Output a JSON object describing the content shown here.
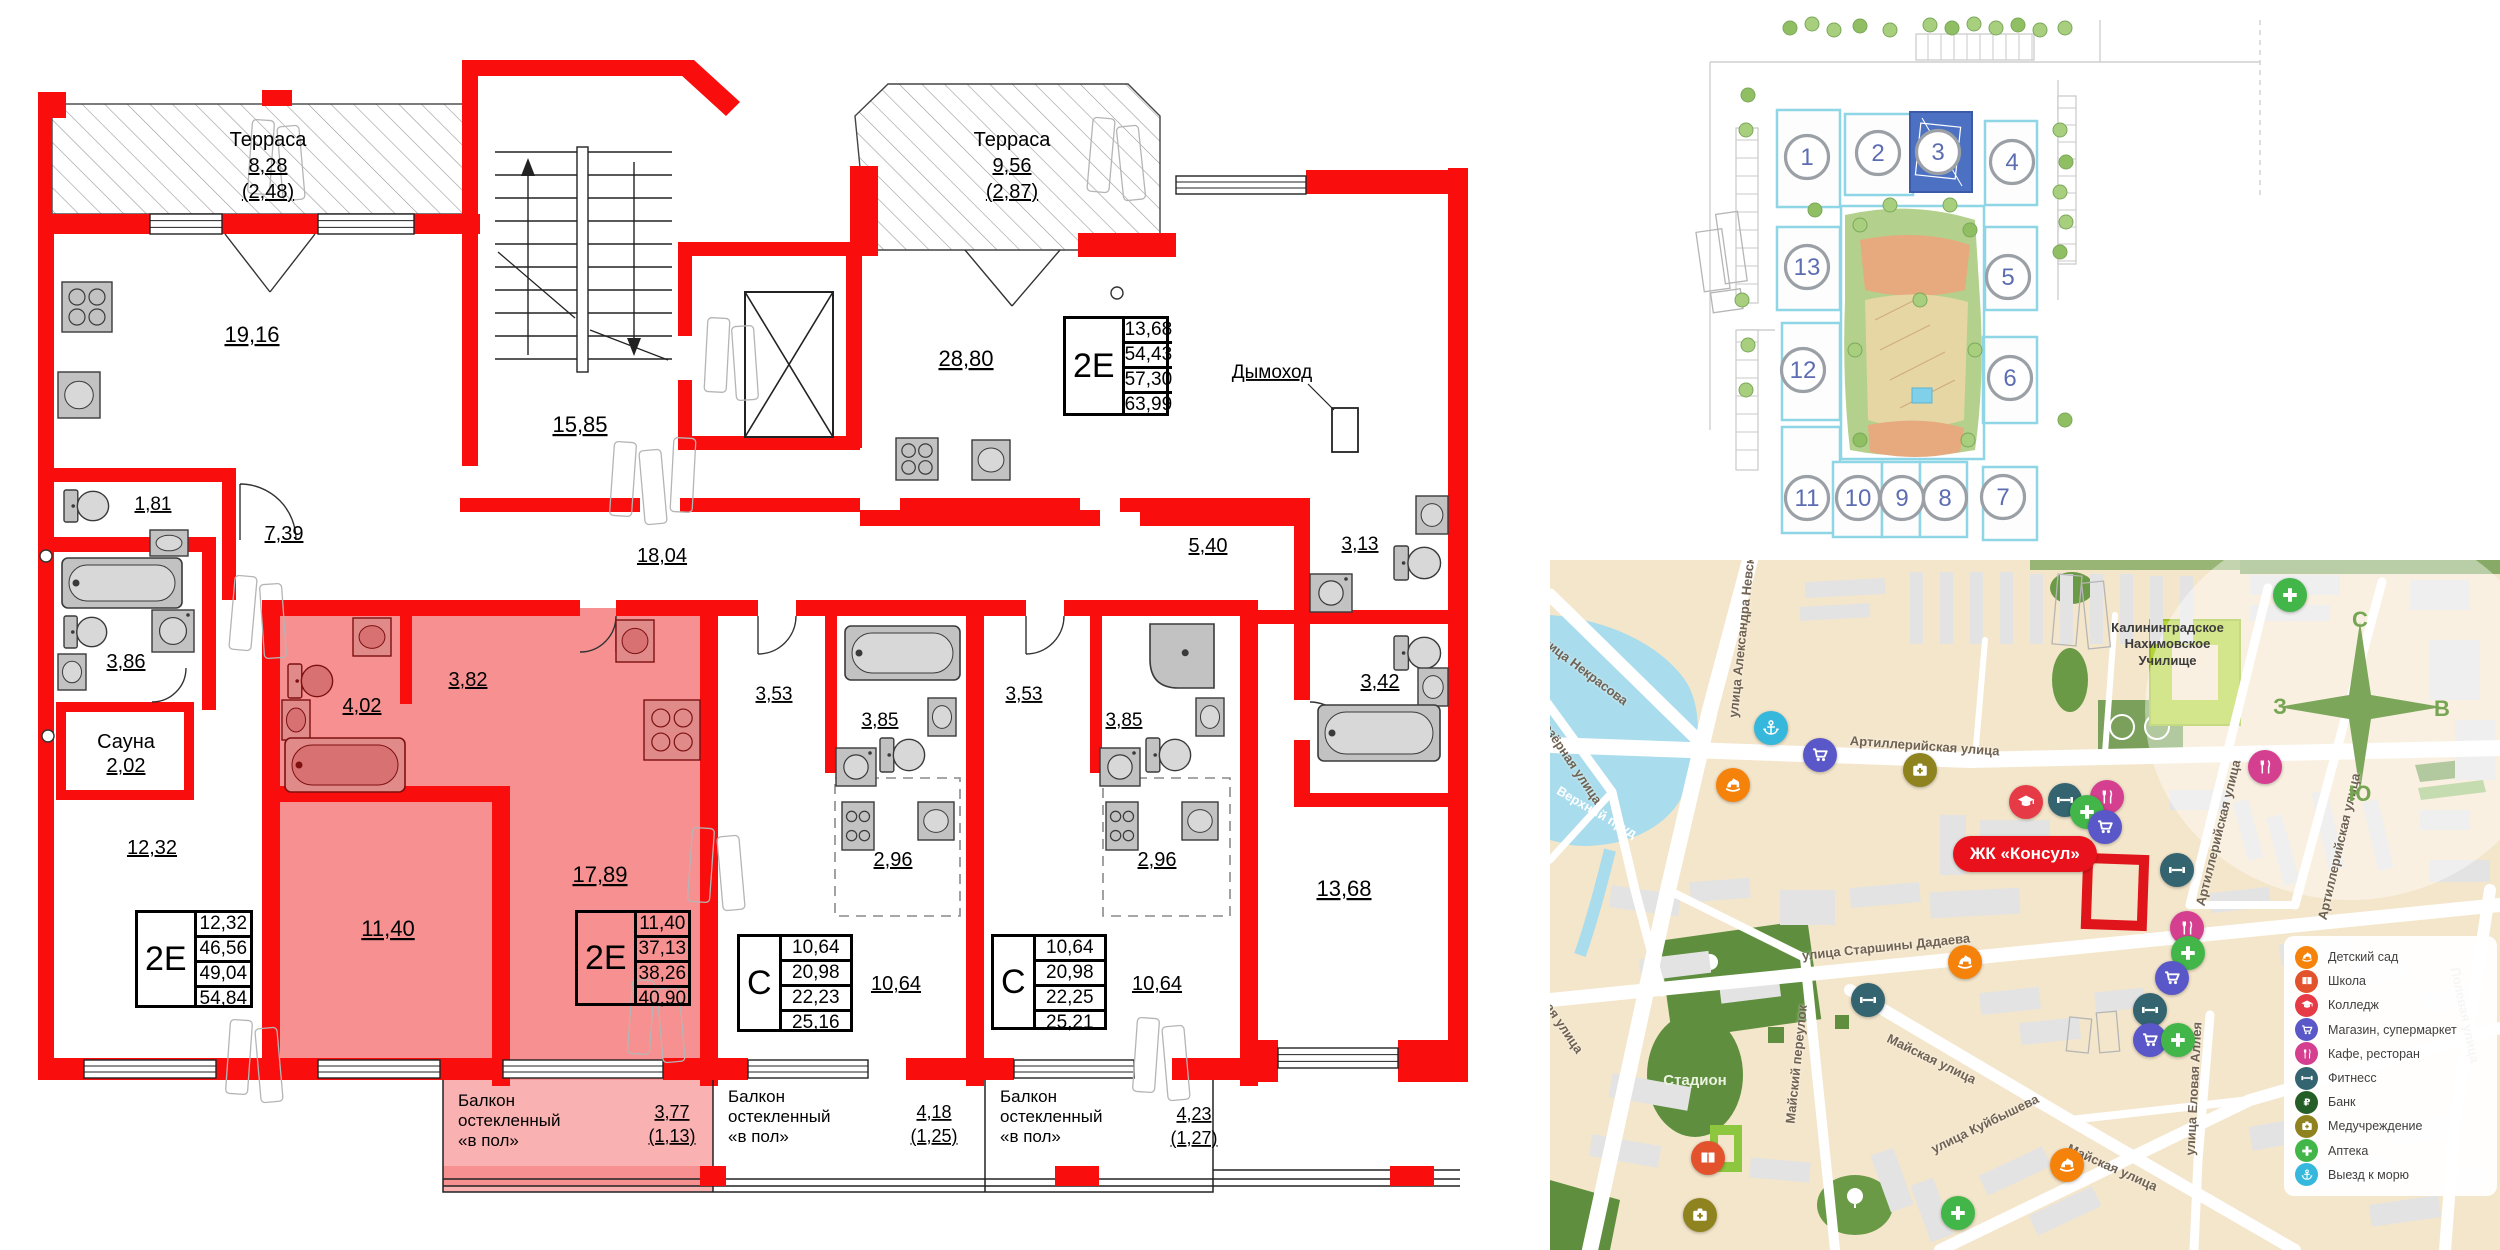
{
  "accent_colors": {
    "wall_red": "#f90d0d",
    "highlight_pink": "#f79191",
    "selected_building_blue": "#4d71c2",
    "map_land": "#f4e6cb",
    "badge_red": "#e8111c"
  },
  "floorplan": {
    "labels": [
      {
        "t": "Терраса",
        "x": 268,
        "y": 146,
        "fs": 20
      },
      {
        "t": "8,28",
        "x": 268,
        "y": 172,
        "fs": 20,
        "u": 1
      },
      {
        "t": "(2,48)",
        "x": 268,
        "y": 198,
        "fs": 20,
        "u": 1
      },
      {
        "t": "19,16",
        "x": 252,
        "y": 342,
        "fs": 22,
        "u": 1
      },
      {
        "t": "15,85",
        "x": 580,
        "y": 432,
        "fs": 22,
        "u": 1
      },
      {
        "t": "Терраса",
        "x": 1012,
        "y": 146,
        "fs": 20
      },
      {
        "t": "9,56",
        "x": 1012,
        "y": 172,
        "fs": 20,
        "u": 1
      },
      {
        "t": "(2,87)",
        "x": 1012,
        "y": 198,
        "fs": 20,
        "u": 1
      },
      {
        "t": "28,80",
        "x": 966,
        "y": 366,
        "fs": 22,
        "u": 1
      },
      {
        "t": "Дымоход",
        "x": 1272,
        "y": 378,
        "fs": 19,
        "u": 1
      },
      {
        "t": "1,81",
        "x": 153,
        "y": 510,
        "fs": 19,
        "u": 1
      },
      {
        "t": "7,39",
        "x": 284,
        "y": 540,
        "fs": 20,
        "u": 1
      },
      {
        "t": "3,86",
        "x": 126,
        "y": 668,
        "fs": 20,
        "u": 1
      },
      {
        "t": "Сауна",
        "x": 126,
        "y": 748,
        "fs": 20
      },
      {
        "t": "2,02",
        "x": 126,
        "y": 772,
        "fs": 20,
        "u": 1
      },
      {
        "t": "12,32",
        "x": 152,
        "y": 854,
        "fs": 20,
        "u": 1
      },
      {
        "t": "4,02",
        "x": 362,
        "y": 712,
        "fs": 20,
        "u": 1
      },
      {
        "t": "3,82",
        "x": 468,
        "y": 686,
        "fs": 20,
        "u": 1
      },
      {
        "t": "18,04",
        "x": 662,
        "y": 562,
        "fs": 20,
        "u": 1
      },
      {
        "t": "3,53",
        "x": 774,
        "y": 700,
        "fs": 19,
        "u": 1
      },
      {
        "t": "3,85",
        "x": 880,
        "y": 726,
        "fs": 19,
        "u": 1
      },
      {
        "t": "3,53",
        "x": 1024,
        "y": 700,
        "fs": 19,
        "u": 1
      },
      {
        "t": "3,85",
        "x": 1124,
        "y": 726,
        "fs": 19,
        "u": 1
      },
      {
        "t": "2,96",
        "x": 893,
        "y": 866,
        "fs": 20,
        "u": 1
      },
      {
        "t": "2,96",
        "x": 1157,
        "y": 866,
        "fs": 20,
        "u": 1
      },
      {
        "t": "10,64",
        "x": 896,
        "y": 990,
        "fs": 20,
        "u": 1
      },
      {
        "t": "10,64",
        "x": 1157,
        "y": 990,
        "fs": 20,
        "u": 1
      },
      {
        "t": "11,40",
        "x": 388,
        "y": 936,
        "fs": 22,
        "u": 1
      },
      {
        "t": "17,89",
        "x": 600,
        "y": 882,
        "fs": 22,
        "u": 1
      },
      {
        "t": "5,40",
        "x": 1208,
        "y": 552,
        "fs": 20,
        "u": 1
      },
      {
        "t": "3,13",
        "x": 1360,
        "y": 550,
        "fs": 19,
        "u": 1
      },
      {
        "t": "3,42",
        "x": 1380,
        "y": 688,
        "fs": 20,
        "u": 1
      },
      {
        "t": "13,68",
        "x": 1344,
        "y": 896,
        "fs": 22,
        "u": 1
      },
      {
        "t": "Балкон",
        "x": 458,
        "y": 1106,
        "fs": 17,
        "a": "s"
      },
      {
        "t": "остекленный",
        "x": 458,
        "y": 1126,
        "fs": 17,
        "a": "s"
      },
      {
        "t": "«в пол»",
        "x": 458,
        "y": 1146,
        "fs": 17,
        "a": "s"
      },
      {
        "t": "3,77",
        "x": 672,
        "y": 1118,
        "fs": 18,
        "u": 1
      },
      {
        "t": "(1,13)",
        "x": 672,
        "y": 1142,
        "fs": 18,
        "u": 1
      },
      {
        "t": "Балкон",
        "x": 728,
        "y": 1102,
        "fs": 17,
        "a": "s"
      },
      {
        "t": "остекленный",
        "x": 728,
        "y": 1122,
        "fs": 17,
        "a": "s"
      },
      {
        "t": "«в пол»",
        "x": 728,
        "y": 1142,
        "fs": 17,
        "a": "s"
      },
      {
        "t": "4,18",
        "x": 934,
        "y": 1118,
        "fs": 18,
        "u": 1
      },
      {
        "t": "(1,25)",
        "x": 934,
        "y": 1142,
        "fs": 18,
        "u": 1
      },
      {
        "t": "Балкон",
        "x": 1000,
        "y": 1102,
        "fs": 17,
        "a": "s"
      },
      {
        "t": "остекленный",
        "x": 1000,
        "y": 1122,
        "fs": 17,
        "a": "s"
      },
      {
        "t": "«в пол»",
        "x": 1000,
        "y": 1142,
        "fs": 17,
        "a": "s"
      },
      {
        "t": "4,23",
        "x": 1194,
        "y": 1120,
        "fs": 18,
        "u": 1
      },
      {
        "t": "(1,27)",
        "x": 1194,
        "y": 1144,
        "fs": 18,
        "u": 1
      }
    ],
    "unit_tables": [
      {
        "type": "2Е",
        "rows": [
          "13,68",
          "54,43",
          "57,30",
          "63,99"
        ],
        "x": 1063,
        "y": 316,
        "w": 100,
        "h": 94
      },
      {
        "type": "2Е",
        "rows": [
          "12,32",
          "46,56",
          "49,04",
          "54,84"
        ],
        "x": 135,
        "y": 910,
        "w": 112,
        "h": 92
      },
      {
        "type": "2Е",
        "rows": [
          "11,40",
          "37,13",
          "38,26",
          "40,90"
        ],
        "x": 575,
        "y": 910,
        "w": 110,
        "h": 90
      },
      {
        "type": "С",
        "rows": [
          "10,64",
          "20,98",
          "22,23",
          "25,16"
        ],
        "x": 737,
        "y": 934,
        "w": 110,
        "h": 92
      },
      {
        "type": "С",
        "rows": [
          "10,64",
          "20,98",
          "22,25",
          "25,21"
        ],
        "x": 991,
        "y": 934,
        "w": 110,
        "h": 90
      }
    ]
  },
  "siteplan": {
    "highlighted_building": "3",
    "buildings": [
      {
        "n": "1",
        "x": 247,
        "y": 157
      },
      {
        "n": "2",
        "x": 318,
        "y": 153
      },
      {
        "n": "3",
        "x": 378,
        "y": 152
      },
      {
        "n": "4",
        "x": 452,
        "y": 162
      },
      {
        "n": "13",
        "x": 247,
        "y": 267
      },
      {
        "n": "5",
        "x": 448,
        "y": 277
      },
      {
        "n": "12",
        "x": 243,
        "y": 370
      },
      {
        "n": "6",
        "x": 450,
        "y": 378
      },
      {
        "n": "11",
        "x": 247,
        "y": 498
      },
      {
        "n": "10",
        "x": 298,
        "y": 498
      },
      {
        "n": "9",
        "x": 342,
        "y": 498
      },
      {
        "n": "8",
        "x": 385,
        "y": 498
      },
      {
        "n": "7",
        "x": 443,
        "y": 497
      }
    ]
  },
  "map": {
    "title_badge": "ЖК «Консул»",
    "compass": {
      "n": "С",
      "e": "В",
      "s": "Ю",
      "w": "З"
    },
    "streets": [
      {
        "t": "улица Некрасова",
        "x": -12,
        "y": 68,
        "r": 37
      },
      {
        "t": "улица Александра Невского",
        "x": 183,
        "y": 150,
        "r": -84
      },
      {
        "t": "Верхнеозёрная улица",
        "x": -30,
        "y": 118,
        "r": 56
      },
      {
        "t": "Верхний пруд",
        "x": 8,
        "y": 222,
        "r": 30,
        "c": "#ffffff"
      },
      {
        "t": "Артиллерийская улица",
        "x": 300,
        "y": 173,
        "r": 4
      },
      {
        "t": "Артиллерийская улица",
        "x": 650,
        "y": 338,
        "r": -76
      },
      {
        "t": "Артиллерийская улица",
        "x": 772,
        "y": 352,
        "r": -77
      },
      {
        "t": "улица Старшины Дадаева",
        "x": 252,
        "y": 388,
        "r": -6
      },
      {
        "t": "Майский переулок",
        "x": 240,
        "y": 556,
        "r": -84
      },
      {
        "t": "Майская улица",
        "x": 338,
        "y": 470,
        "r": 26
      },
      {
        "t": "улица Куйбышева",
        "x": 382,
        "y": 582,
        "r": -26
      },
      {
        "t": "Майская улица",
        "x": 518,
        "y": 580,
        "r": 24
      },
      {
        "t": "улица Еловая Аллея",
        "x": 640,
        "y": 588,
        "r": -87
      },
      {
        "t": "Полевая улица",
        "x": 905,
        "y": 400,
        "r": 78
      },
      {
        "t": "Уфимская улица",
        "x": -30,
        "y": 395,
        "r": 56
      }
    ],
    "area_labels": [
      {
        "t": "Калининградское\nНахимовское\nУчилище",
        "x": 545,
        "y": 60,
        "w": 145,
        "fs": 13,
        "c": "#3c3c3c"
      },
      {
        "t": "Стадион",
        "x": 100,
        "y": 512,
        "w": 90,
        "fs": 15,
        "c": "#ebf3e0"
      }
    ],
    "pois": [
      {
        "k": "sea",
        "x": 221,
        "y": 168
      },
      {
        "k": "shop",
        "x": 270,
        "y": 195
      },
      {
        "k": "kindergarten",
        "x": 183,
        "y": 225
      },
      {
        "k": "med",
        "x": 370,
        "y": 210
      },
      {
        "k": "college",
        "x": 476,
        "y": 242
      },
      {
        "k": "pharmacy",
        "x": 740,
        "y": 35
      },
      {
        "k": "cafe",
        "x": 715,
        "y": 207
      },
      {
        "k": "fitness",
        "x": 515,
        "y": 240
      },
      {
        "k": "cafe",
        "x": 557,
        "y": 237
      },
      {
        "k": "pharmacy",
        "x": 537,
        "y": 252
      },
      {
        "k": "shop",
        "x": 555,
        "y": 267
      },
      {
        "k": "fitness",
        "x": 627,
        "y": 310
      },
      {
        "k": "cafe",
        "x": 637,
        "y": 368
      },
      {
        "k": "pharmacy",
        "x": 638,
        "y": 393
      },
      {
        "k": "shop",
        "x": 622,
        "y": 418
      },
      {
        "k": "fitness",
        "x": 600,
        "y": 450
      },
      {
        "k": "shop",
        "x": 600,
        "y": 480
      },
      {
        "k": "pharmacy",
        "x": 628,
        "y": 480
      },
      {
        "k": "kindergarten",
        "x": 415,
        "y": 402
      },
      {
        "k": "fitness",
        "x": 318,
        "y": 440
      },
      {
        "k": "school",
        "x": 158,
        "y": 598
      },
      {
        "k": "med",
        "x": 150,
        "y": 655
      },
      {
        "k": "pharmacy",
        "x": 408,
        "y": 653
      },
      {
        "k": "kindergarten",
        "x": 517,
        "y": 605
      }
    ],
    "legend": [
      {
        "k": "kindergarten",
        "label": "Детский сад",
        "color": "#f5820b"
      },
      {
        "k": "school",
        "label": "Школа",
        "color": "#e2532d"
      },
      {
        "k": "college",
        "label": "Колледж",
        "color": "#e63b47"
      },
      {
        "k": "shop",
        "label": "Магазин, супермаркет",
        "color": "#5a58c8"
      },
      {
        "k": "cafe",
        "label": "Кафе, ресторан",
        "color": "#d4408f"
      },
      {
        "k": "fitness",
        "label": "Фитнесс",
        "color": "#33646f"
      },
      {
        "k": "bank",
        "label": "Банк",
        "color": "#265e28"
      },
      {
        "k": "med",
        "label": "Медучреждение",
        "color": "#8f831f"
      },
      {
        "k": "pharmacy",
        "label": "Аптека",
        "color": "#43b649"
      },
      {
        "k": "sea",
        "label": "Выезд к морю",
        "color": "#35b8dc"
      }
    ]
  }
}
